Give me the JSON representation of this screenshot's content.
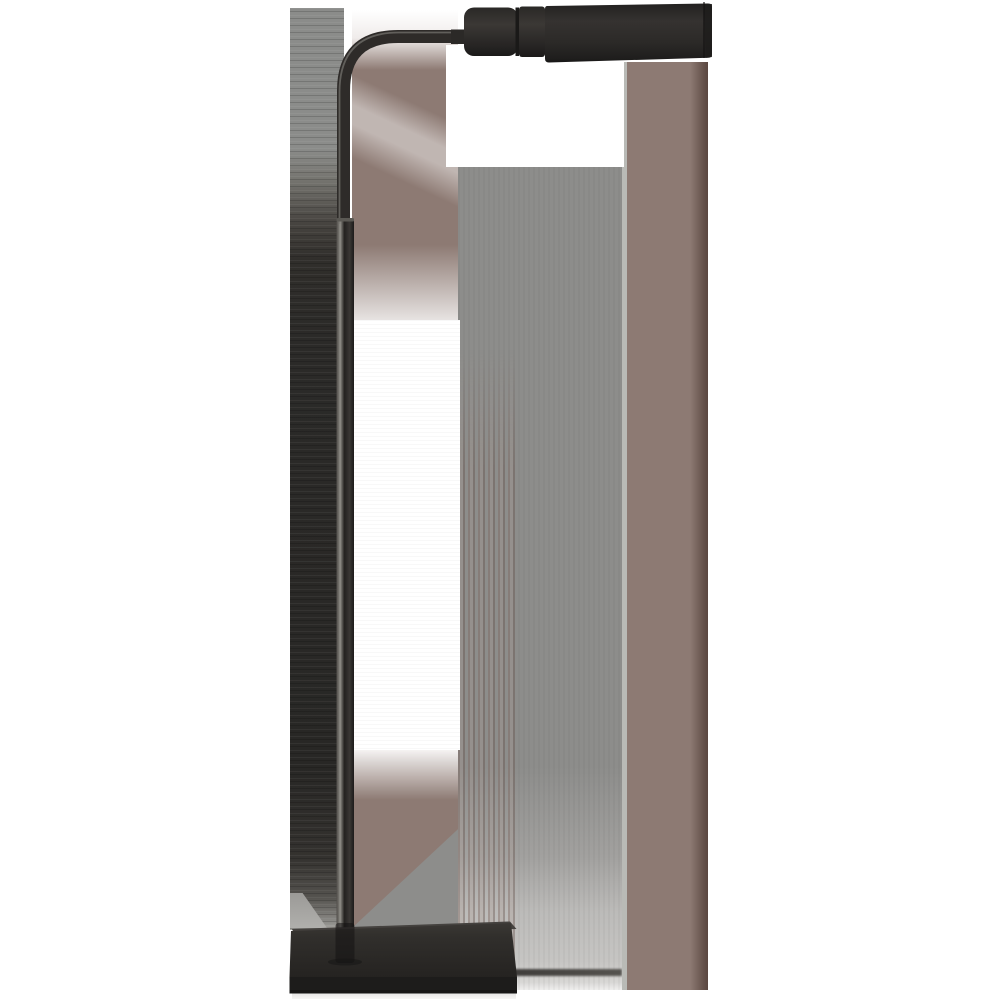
{
  "scene": {
    "type": "product-photo",
    "subject": "pharmacy-style floor lamp",
    "finish": "dark bronze / aged iron",
    "background": "white with gray and mauve texture-smear artifact bands",
    "parts": [
      "horizontal cylindrical shade",
      "shade socket section",
      "curved gooseneck arm",
      "slender upper pole",
      "thicker lower pole with collar",
      "rectangular plinth base"
    ],
    "alt_text": "Bronze adjustable floor lamp with horizontal tubular shade on a curved arm, thin stem and rectangular base"
  },
  "colors": {
    "white": "#ffffff",
    "band-gray": "#8b8c8a",
    "band-dark": "#2b2a28",
    "rect-gray": "#8d8d8b",
    "seam-light": "#b9bab6",
    "mauve": "#8d7a73",
    "mauve-light": "#9c8a83",
    "mauve-dark": "#6e5a53",
    "edge-brown": "#5e4b44",
    "metal-dark": "#2e2b29",
    "metal-mid": "#3a3734",
    "metal-deep": "#1b1a19",
    "metal-highlight": "#85837d",
    "base-top": "#45423f",
    "base-front": "#2f2d2b",
    "plinth": "#1d1c1b"
  }
}
